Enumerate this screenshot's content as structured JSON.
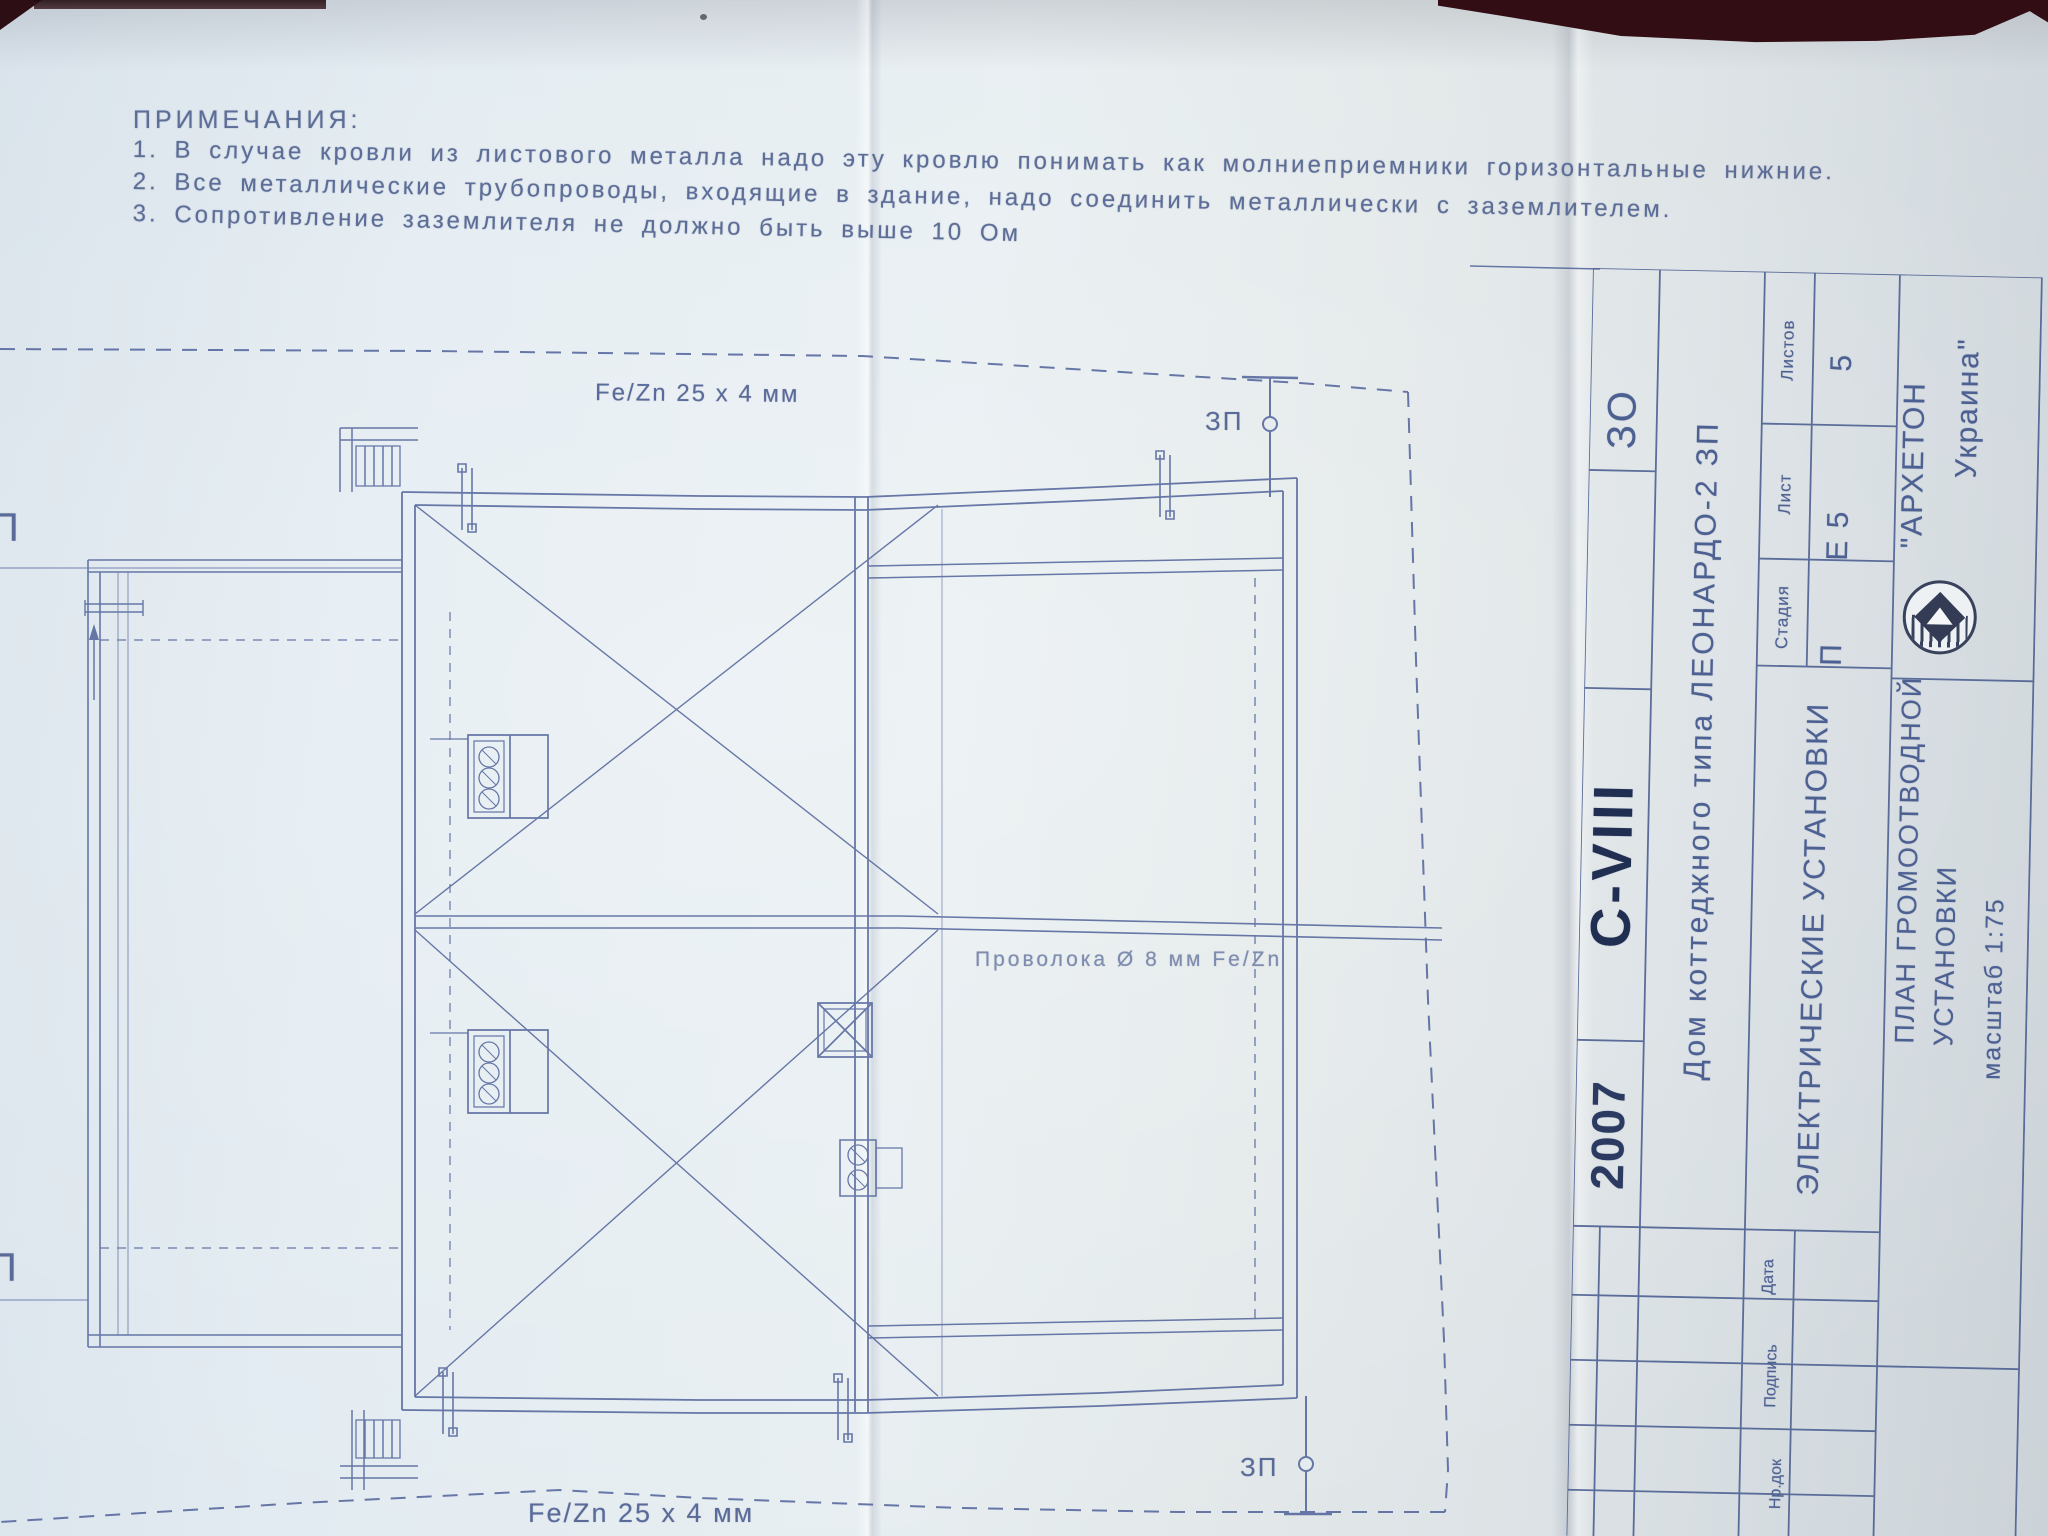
{
  "notes": {
    "title": "ПРИМЕЧАНИЯ:",
    "items": [
      "1.  В  случае  кровли  из  листового  металла  надо  эту  кровлю  понимать  как  молниеприемники  горизонтальные  нижние.",
      "2.  Все  металлические  трубопроводы,  входящие  в  здание,  надо  соединить  металлически  с  заземлителем.",
      "3.  Сопротивление  заземлителя  не  должно  быть  выше  10  Ом"
    ]
  },
  "plan_labels": {
    "tape_top": "Fe/Zn 25 x 4 мм",
    "tape_bottom": "Fe/Zn 25 x 4 мм",
    "wire": "Проволока Ø 8 мм Fe/Zn",
    "zp_top": "ЗП",
    "zp_bottom": "ЗП",
    "edge_top": "П",
    "edge_bottom": "П"
  },
  "title_block": {
    "code": "ЗО",
    "series": "C-VIII",
    "year": "2007",
    "project": "Дом коттеджного типа ЛЕОНАРДО-2 ЗП",
    "section": "ЭЛЕКТРИЧЕСКИЕ УСТАНОВКИ",
    "stage_label": "Стадия",
    "stage_value": "П",
    "sheet_label": "Лист",
    "sheet_value": "Е 5",
    "sheets_label": "Листов",
    "sheets_value": "5",
    "company_line1": "\"АРХЕТОН",
    "company_line2": "Украина\"",
    "drawing_title_line1": "ПЛАН ГРОМООТВОДНОЙ",
    "drawing_title_line2": "УСТАНОВКИ",
    "scale": "масштаб 1:75",
    "col_doc": "Нр.док",
    "col_sign": "Подпись",
    "col_date": "Дата"
  },
  "colors": {
    "ink": "#50629a",
    "ink_dark": "#202e52",
    "paper": "#e3ebf0"
  }
}
